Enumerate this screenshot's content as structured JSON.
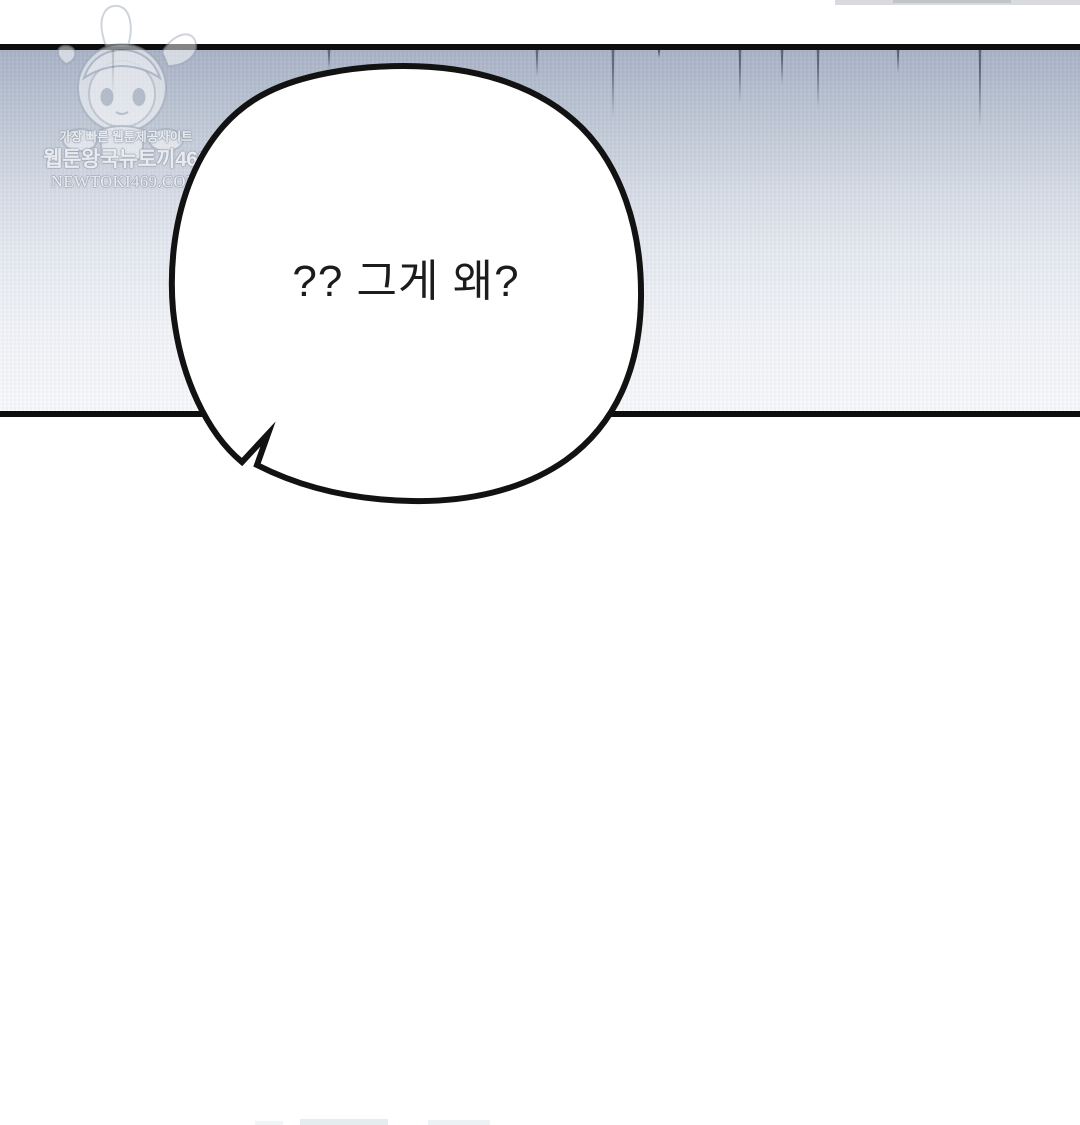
{
  "comic": {
    "bubble_text": "?? 그게 왜?",
    "bubble_fill": "#ffffff",
    "outline_color": "#121212",
    "text_color": "#1c1c1c"
  },
  "watermark": {
    "tagline": "가장 빠른 웹툰제공사이트",
    "site_name": "웹툰왕국뉴토끼469",
    "url": "NEWTOKI469.COM",
    "mascot": "chibi-hooded-character"
  },
  "panel": {
    "border_color": "#0e0e0e",
    "sky_gradient": [
      {
        "pos": 0.0,
        "color": "#a8b2c5"
      },
      {
        "pos": 0.18,
        "color": "#bcc5d3"
      },
      {
        "pos": 0.38,
        "color": "#d5dbe5"
      },
      {
        "pos": 0.55,
        "color": "#e5e9f0"
      },
      {
        "pos": 0.75,
        "color": "#f1f3f7"
      },
      {
        "pos": 1.0,
        "color": "#f8f9fb"
      }
    ],
    "rain_streaks": {
      "color": "#4a5468",
      "lines": [
        {
          "x": 113,
          "length": 47
        },
        {
          "x": 329,
          "length": 20
        },
        {
          "x": 537,
          "length": 27
        },
        {
          "x": 613,
          "length": 68
        },
        {
          "x": 659,
          "length": 8
        },
        {
          "x": 740,
          "length": 53
        },
        {
          "x": 782,
          "length": 35
        },
        {
          "x": 818,
          "length": 58
        },
        {
          "x": 898,
          "length": 23
        },
        {
          "x": 980,
          "length": 78
        }
      ]
    }
  },
  "fragments": {
    "top_right": [
      {
        "x": 835,
        "y": 0,
        "w": 245,
        "h": 5,
        "color": "rgba(185,188,193,0.55)"
      },
      {
        "x": 893,
        "y": 0,
        "w": 118,
        "h": 3,
        "color": "rgba(165,168,175,0.45)"
      }
    ],
    "bottom": [
      {
        "x": 300,
        "y": 1119,
        "w": 88,
        "h": 6,
        "color": "rgba(205,220,222,0.50)"
      },
      {
        "x": 428,
        "y": 1120,
        "w": 62,
        "h": 5,
        "color": "rgba(212,226,228,0.42)"
      },
      {
        "x": 255,
        "y": 1121,
        "w": 28,
        "h": 4,
        "color": "rgba(220,230,232,0.38)"
      }
    ]
  }
}
